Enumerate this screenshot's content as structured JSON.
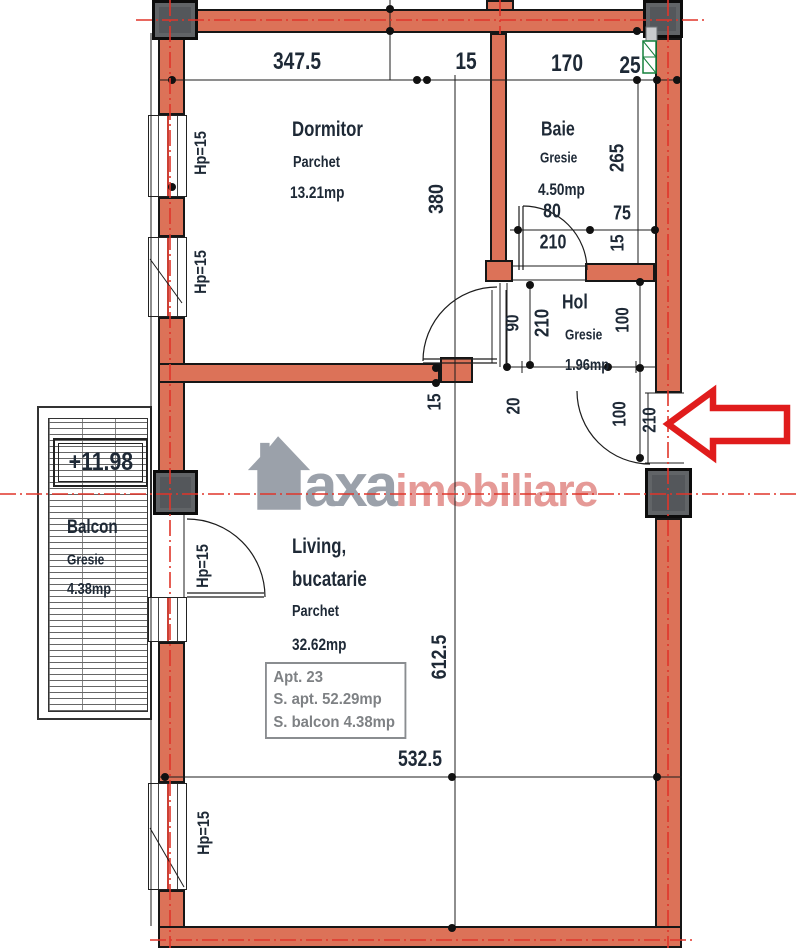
{
  "watermark": {
    "brand": "axa",
    "suffix": "imobiliare"
  },
  "rooms": {
    "dormitor": {
      "name": "Dormitor",
      "floor": "Parchet",
      "area": "13.21mp"
    },
    "baie": {
      "name": "Baie",
      "floor": "Gresie",
      "area": "4.50mp"
    },
    "hol": {
      "name": "Hol",
      "floor": "Gresie",
      "area": "1.96mp"
    },
    "living": {
      "name_line1": "Living,",
      "name_line2": "bucatarie",
      "floor": "Parchet",
      "area": "32.62mp"
    },
    "balcon": {
      "name": "Balcon",
      "floor": "Gresie",
      "area": "4.38mp",
      "level": "+11.98"
    }
  },
  "apartment": {
    "number": "Apt. 23",
    "apt_area": "S. apt. 52.29mp",
    "balcony_area": "S. balcon 4.38mp"
  },
  "dims": {
    "top_347_5": "347.5",
    "top_15": "15",
    "top_170": "170",
    "top_25": "25",
    "dormitor_depth": "380",
    "parapet": "Hp=15",
    "baie_depth": "265",
    "baie_door_w": "80",
    "baie_75": "75",
    "baie_door_h": "210",
    "baie_wall_15": "15",
    "hol_door_w": "90",
    "hol_door_h": "210",
    "hol_100": "100",
    "div_15": "15",
    "div_20": "20",
    "entry_100": "100",
    "entry_210": "210",
    "living_depth": "612.5",
    "living_width": "532.5"
  },
  "colors": {
    "wall": "#dc7258",
    "axis_red": "#e0352a",
    "arrow_red": "#e01c1c",
    "pillar": "#54575b",
    "label": "#1e2936",
    "watermark_gray": "#9ba1aa",
    "watermark_pink": "#e59a97"
  }
}
